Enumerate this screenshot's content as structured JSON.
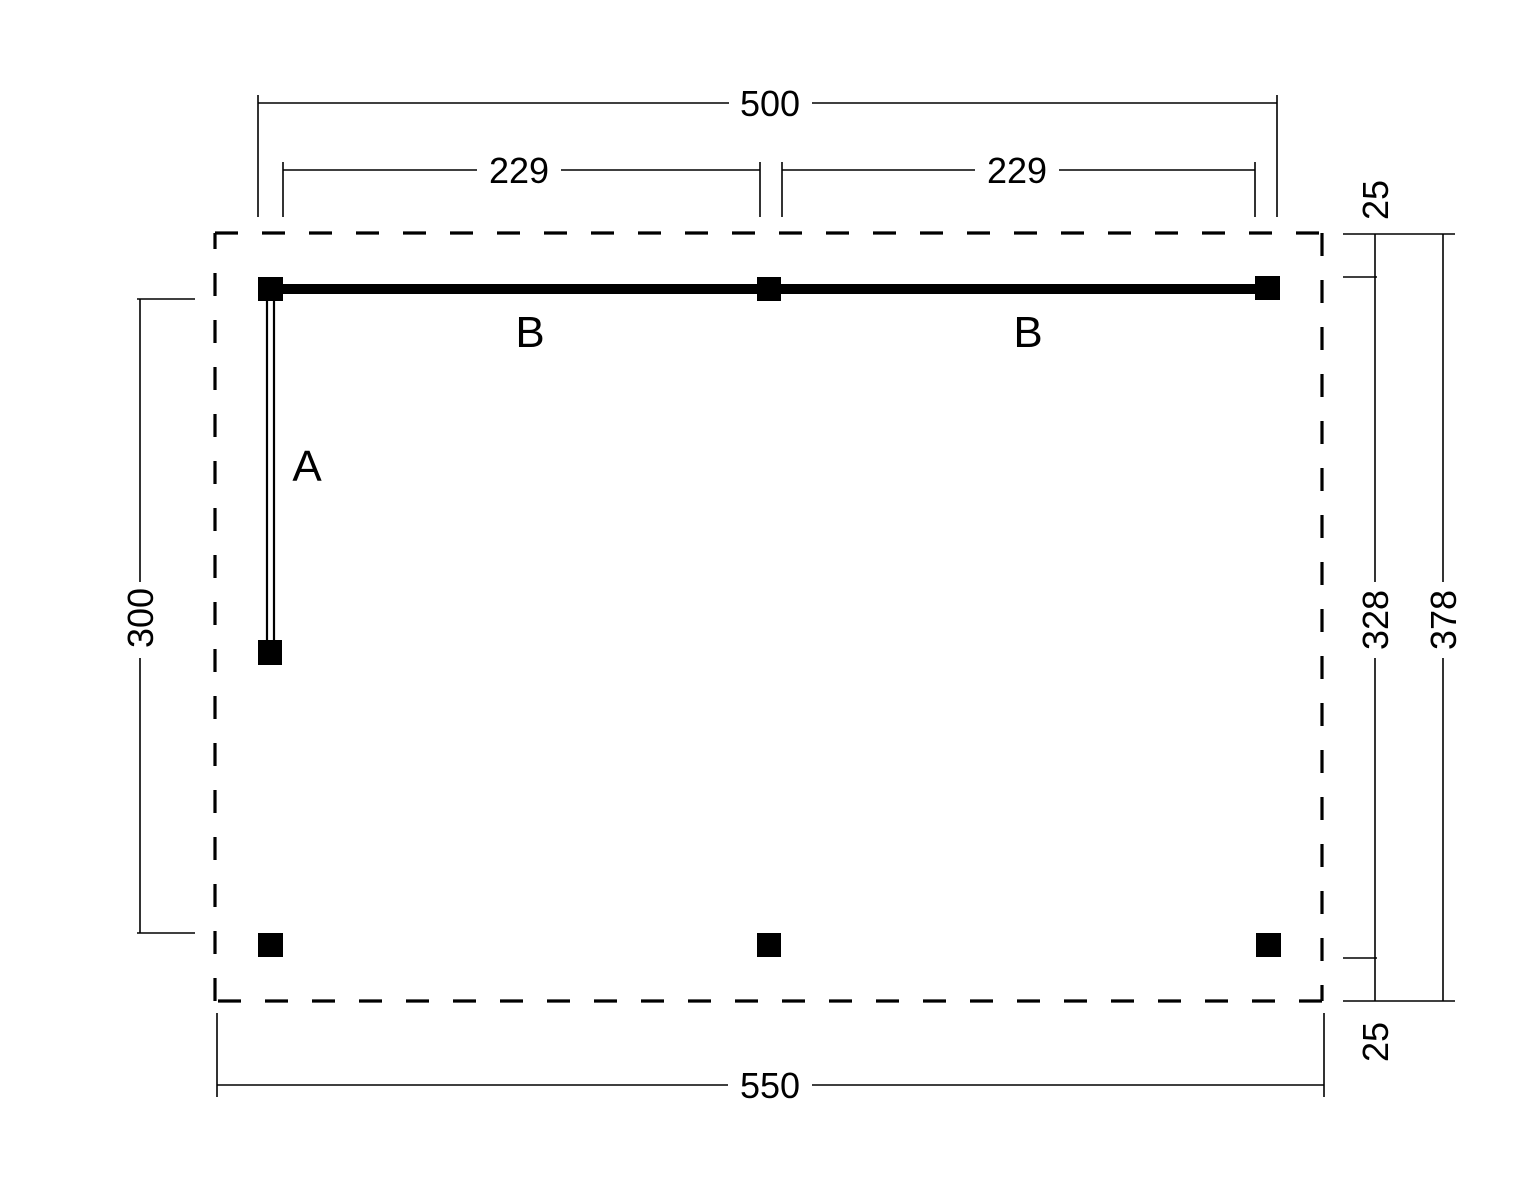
{
  "drawing": {
    "type": "floor-plan-technical-drawing",
    "background_color": "#ffffff",
    "line_color": "#000000",
    "labels": {
      "wall_a": "A",
      "beam_left": "B",
      "beam_right": "B"
    },
    "dimensions": {
      "overall_width_top": "500",
      "bay_left": "229",
      "bay_right": "229",
      "overhang_top_right": "25",
      "depth_inner": "328",
      "depth_outer": "378",
      "overhang_bottom_right": "25",
      "side_height_left": "300",
      "overall_width_bottom": "550"
    }
  }
}
